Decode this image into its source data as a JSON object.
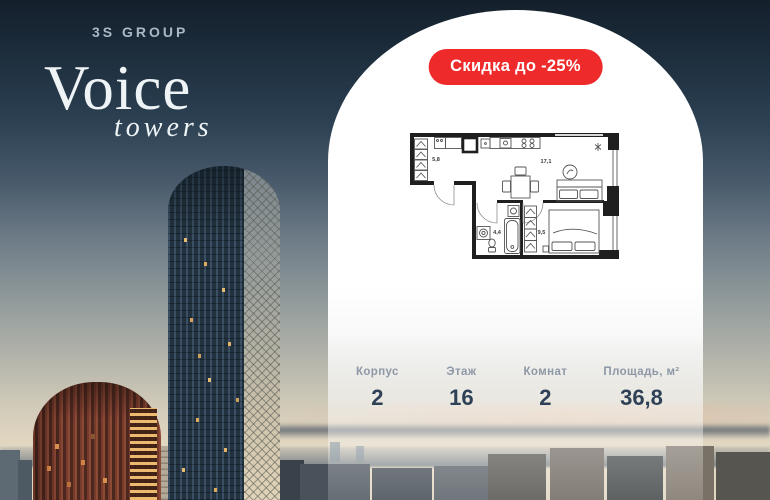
{
  "brand": {
    "group_name": "3S GROUP",
    "project_name": "Voice",
    "project_sub": "towers"
  },
  "badge": {
    "label": "Скидка до -25%"
  },
  "floor_plan": {
    "room_areas": {
      "hallway": "5,8",
      "living_kitchen": "17,1",
      "bathroom": "4,4",
      "bedroom": "9,5"
    }
  },
  "stats": {
    "items": [
      {
        "label": "Корпус",
        "value": "2"
      },
      {
        "label": "Этаж",
        "value": "16"
      },
      {
        "label": "Комнат",
        "value": "2"
      },
      {
        "label": "Площадь, м²",
        "value": "36,8"
      }
    ]
  },
  "colors": {
    "badge_red": "#ee2a2a",
    "stats_value_navy": "#2e4156",
    "stats_label_gray": "#8d98a6"
  }
}
